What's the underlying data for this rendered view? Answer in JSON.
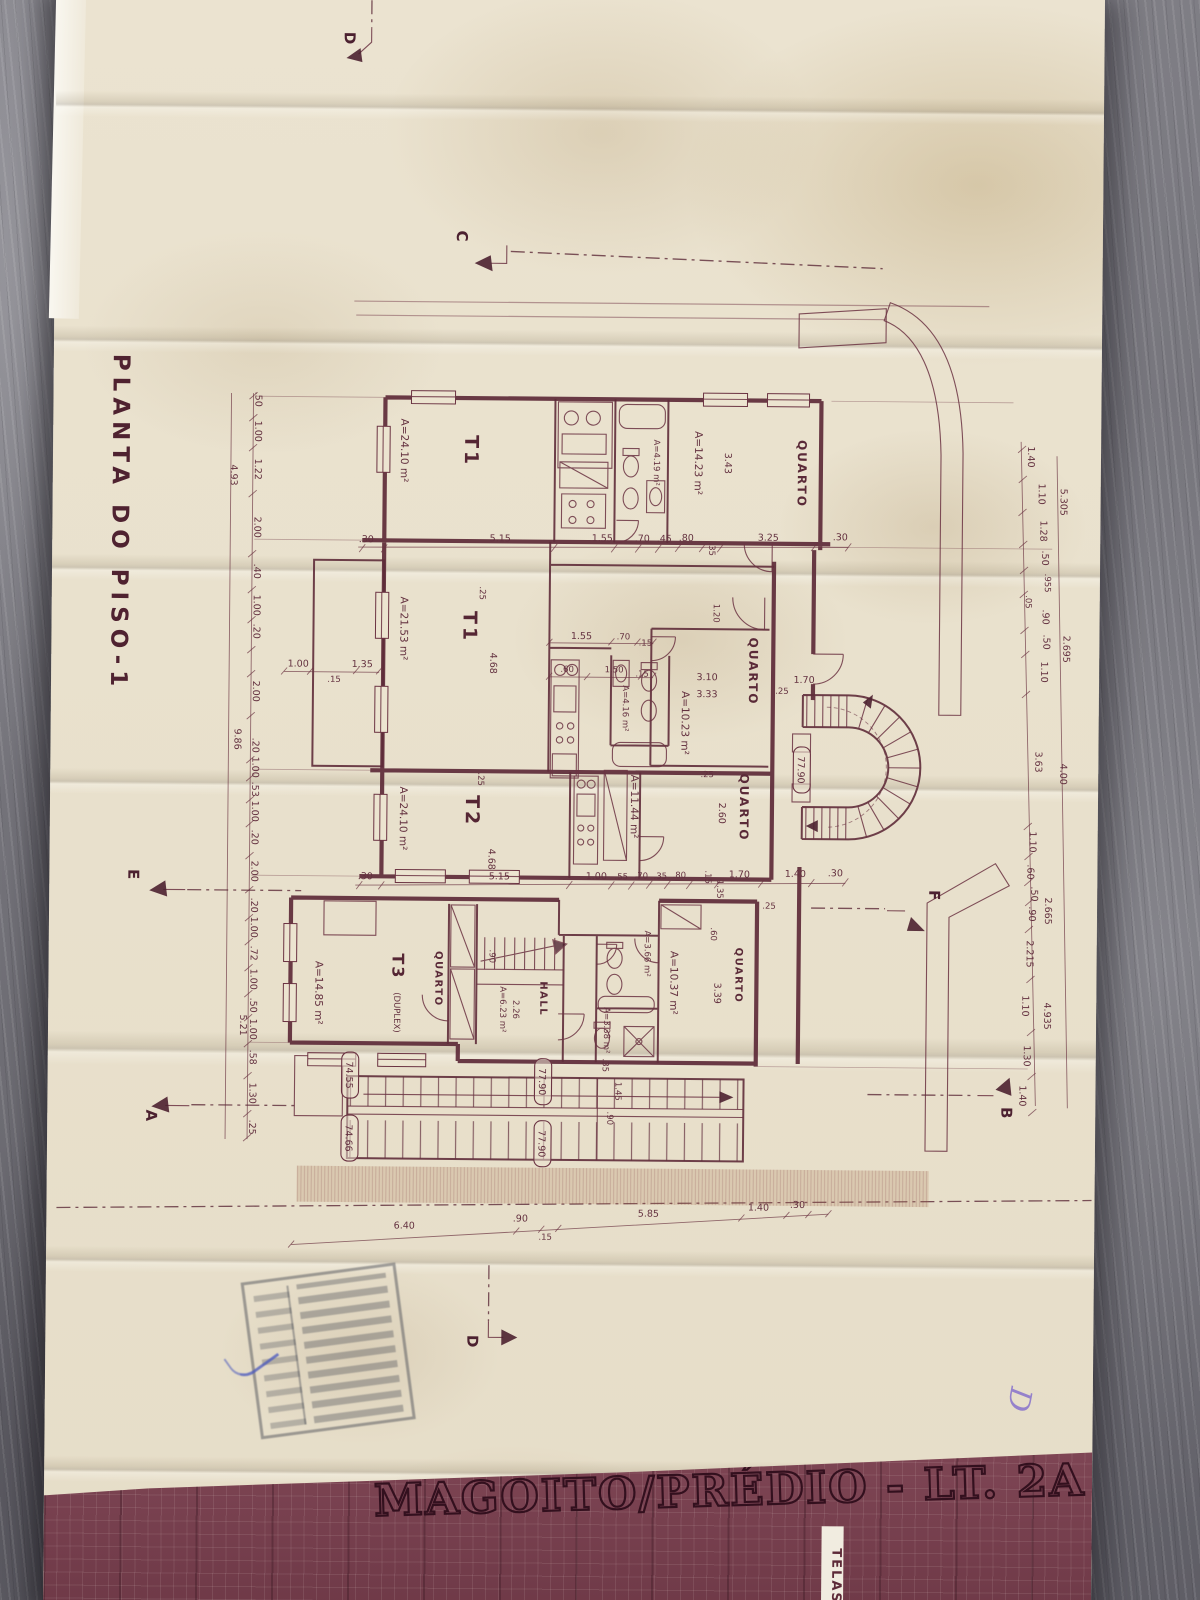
{
  "paper": {
    "plan_title": "PLANTA DO PISO-1"
  },
  "titleblock": {
    "project": "MAGOITO/PRÉDIO - LT. 2A",
    "tag": "TELAS"
  },
  "annotations": {
    "handwritten": "D"
  },
  "sections": {
    "a": "A",
    "b": "B",
    "c": "C",
    "d": "D",
    "e": "E",
    "f": "F"
  },
  "levels": {
    "l1": "77.90",
    "l2": "74.55",
    "l3": "74.66"
  },
  "rooms": {
    "t1_upper": {
      "label": "T1",
      "area": "A=24.10 m²"
    },
    "quarto_upper": {
      "label": "QUARTO",
      "area": "A=14.23 m²"
    },
    "bath_upper": {
      "area": "A=4.19 m²"
    },
    "t1_mid": {
      "label": "T1",
      "area": "A=21.53 m²"
    },
    "bath_mid": {
      "area": "A=4.16 m²"
    },
    "quarto_mid": {
      "label": "QUARTO",
      "area": "A=10.23 m²"
    },
    "quarto_low": {
      "label": "QUARTO",
      "area": "A=11.44 m²"
    },
    "t2": {
      "label": "T2",
      "area": "A=24.10 m²"
    },
    "t3": {
      "label": "T3",
      "sub": "(DUPLEX)",
      "area": "A=14.85 m²"
    },
    "quarto_t3": {
      "label": "QUARTO"
    },
    "hall": {
      "label": "HALL",
      "area": "A=6.23 m²"
    },
    "bath_t3": {
      "area": "A=3.66 m²"
    },
    "wc_t3": {
      "area": "A=3.38 m²"
    },
    "quarto_bot": {
      "label": "QUARTO",
      "area": "A=10.37 m²"
    }
  },
  "dims": {
    "top": [
      ".30",
      "5.15",
      "1.55",
      ".70",
      ".45",
      ".80",
      ".35",
      "3.25",
      ".30"
    ],
    "mid": [
      ".30",
      "5.15",
      "1.00",
      ".55",
      ".70",
      ".35",
      ".80",
      "1.70",
      "1.40",
      ".30"
    ],
    "bottom": [
      "6.40",
      ".90",
      ".15",
      "5.85",
      "1.40",
      ".30"
    ],
    "left": [
      ".50",
      "1.00",
      "1.22",
      "2.00",
      ".40",
      "1.00",
      ".20",
      "2.00",
      ".20",
      "1.00",
      ".53",
      "1.00",
      ".20",
      "2.00",
      ".20",
      "1.00",
      ".72",
      "1.00",
      ".50",
      "1.00",
      ".58",
      "1.30",
      ".25"
    ],
    "left_outer": [
      "4.93",
      "9.86",
      "5.21"
    ],
    "right": [
      "1.40",
      "1.10",
      "1.28",
      ".50",
      ".955",
      ".05",
      ".90",
      ".50",
      "1.10",
      "1.10",
      ".60",
      ".50",
      ".90",
      "2.215",
      "1.10",
      "1.30",
      "1.40"
    ],
    "right_outer": [
      "5.305",
      "2.695",
      "3.63",
      "4.00",
      "2.665",
      "4.935"
    ],
    "kitchen": [
      "1.55",
      ".70",
      ".15"
    ],
    "kitchen_in": [
      ".60",
      "1.50",
      ".15"
    ],
    "terrace": [
      "1.00",
      "1.35",
      ".15"
    ],
    "room": {
      "q_up_w": "3.43",
      "t1_h": "4.68",
      "t1_off": ".25",
      "q_mid_w": "3.10",
      "q_mid_h": "3.33",
      "q_mid_door": "1.20",
      "q_low_h": "2.60",
      "q_low_off": ".25",
      "t2_h": "4.68",
      "t2_off": ".25",
      "stair_w": ".90",
      "hall_d": "2.26",
      "q_bot_h": "3.39",
      "q_bot_w": ".60",
      "door_off": "1.35",
      "off15": ".15",
      "off25": ".25",
      "entry_w": "1.70",
      "entry_off": ".25",
      "st_a": ".35",
      "st_b": "1.45",
      "st_c": ".90"
    }
  }
}
